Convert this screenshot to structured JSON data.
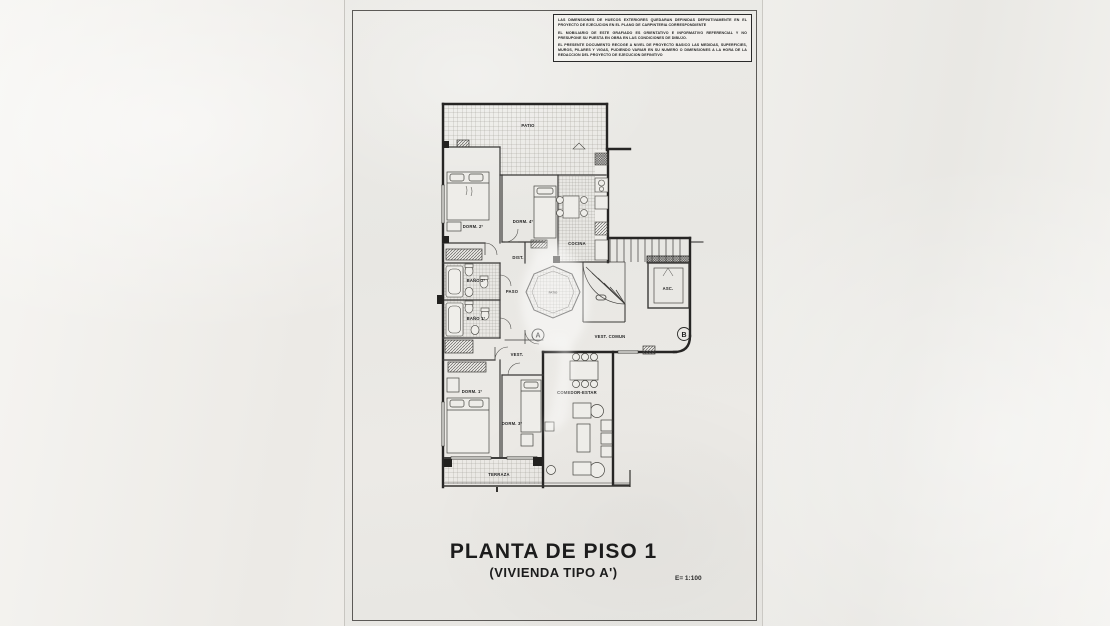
{
  "sheet": {
    "disclaimer": {
      "para1": "LAS DIMENSIONES DE HUECOS EXTERIORES QUEDARAN DEFINIDAS DEFINITIVAMENTE EN EL PROYECTO DE EJECUCION EN EL PLANO DE CARPINTERIA CORRESPONDIENTE",
      "para2": "EL MOBILIARIO DE ESTE GRAFIADO ES ORIENTATIVO E INFORMATIVO REFERENCIAL Y NO PRESUPONE SU PUESTA EN OBRA EN LAS CONDICIONES DE DIBUJO.",
      "para3": "EL PRESENTE DOCUMENTO RECOGE A NIVEL DE PROYECTO BASICO LAS MEDIDAS, SUPERFICIES, MUROS, PILARES Y VIGAS, PUDIENDO VARIAR EN SU NUMERO O DIMENSIONES A LA HORA DE LA REDACCION DEL PROYECTO DE EJECUCION DEFINITIVO"
    },
    "title": "PLANTA DE PISO 1",
    "subtitle": "(VIVIENDA TIPO A')",
    "scale": "E= 1:100"
  },
  "plan": {
    "labels": {
      "patio": "PATIO",
      "dorm2": "DORM. 2º",
      "dorm4": "DORM. 4º",
      "cocina": "COCINA",
      "dist": "DIST.",
      "banyo2": "BAÑO 2º",
      "paso": "PASO",
      "patio_int": "PATIO",
      "banyo1": "BAÑO 1º",
      "asc": "ASC.",
      "vest_comun": "VEST. COMUN",
      "vest": "VEST.",
      "dorm1": "DORM. 1º",
      "comedor": "COMEDOR-ESTAR",
      "dorm3": "DORM. 3º",
      "terraza": "TERRAZA",
      "marker_a": "A",
      "marker_b": "B"
    },
    "colors": {
      "paper": "#e9e8e4",
      "wall": "#262524",
      "partition": "#3a3937",
      "tile_line": "#9a9892",
      "text": "#1f1f1f"
    }
  }
}
